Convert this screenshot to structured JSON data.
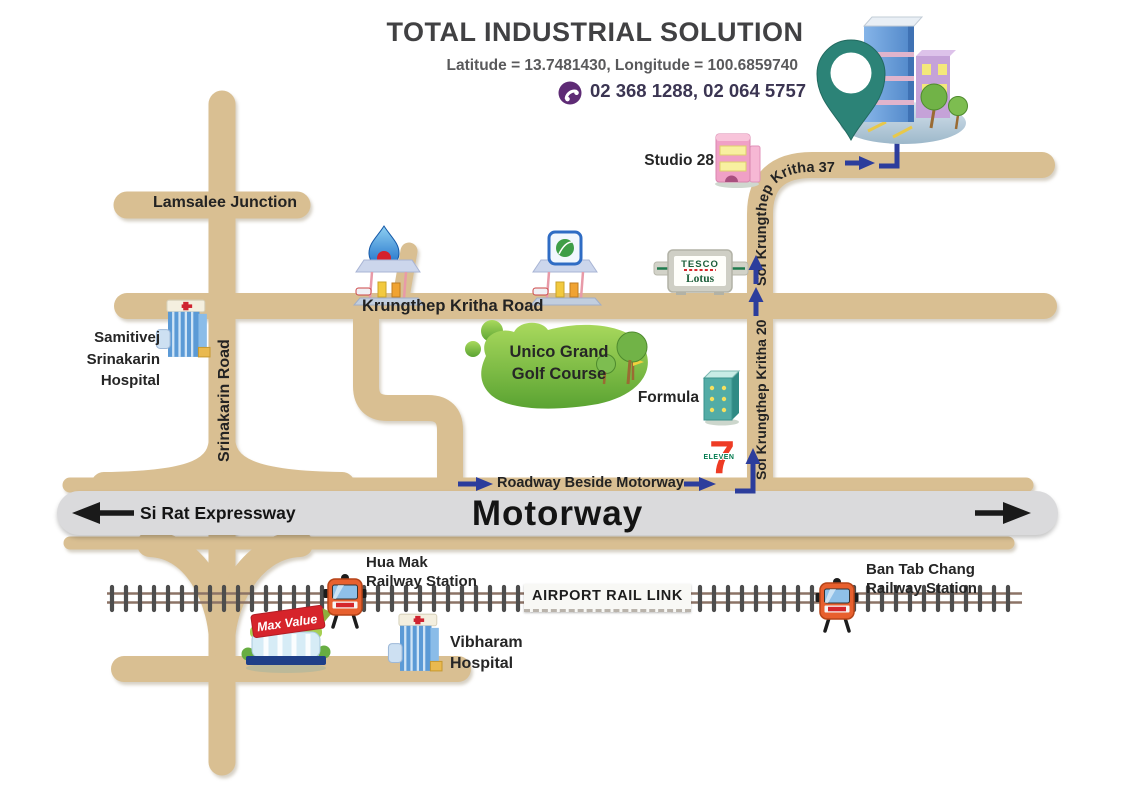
{
  "header": {
    "title": "TOTAL INDUSTRIAL SOLUTION",
    "coordinates": "Latitude = 13.7481430, Longitude = 100.6859740",
    "phone_numbers": "02 368 1288, 02 064 5757"
  },
  "roads": {
    "lamsalee_junction": "Lamsalee Junction",
    "krungthep_kritha_road": "Krungthep Kritha Road",
    "srinakarin_road": "Srinakarin Road",
    "soi_krungthep_kritha_20": "Soi Krungthep Kritha 20",
    "soi_krungthep_kritha_37": "Soi Krungthep Kritha 37",
    "roadway_beside_motorway": "Roadway Beside Motorway",
    "motorway": "Motorway",
    "si_rat_expressway": "Si Rat Expressway"
  },
  "railway": {
    "airport_rail_link": "AIRPORT RAIL LINK",
    "hua_mak": {
      "line1": "Hua Mak",
      "line2": "Railway Station"
    },
    "ban_tab_chang": {
      "line1": "Ban Tab Chang",
      "line2": "Railway Station"
    }
  },
  "places": {
    "samitivej": {
      "line1": "Samitivej",
      "line2": "Srinakarin",
      "line3": "Hospital"
    },
    "studio_28": "Studio 28",
    "tesco": {
      "line1": "TESCO",
      "line2": "Lotus"
    },
    "golf": {
      "line1": "Unico Grand",
      "line2": "Golf Course"
    },
    "formula": "Formula",
    "seven_eleven": {
      "numeral": "7",
      "word": "ELEVEN"
    },
    "max_value": "Max Value",
    "vibharam": {
      "line1": "Vibharam",
      "line2": "Hospital"
    }
  },
  "colors": {
    "road_tan": "#d9bf92",
    "motorway_gray": "#dadadc",
    "route_arrow_blue": "#2c3d9c",
    "rail_tie_gray": "#4d4d4d",
    "rail_brown": "#8c7366",
    "viber_purple": "#5e2b75",
    "golf_green": "#6fb63a",
    "pin_teal": "#2c8377"
  }
}
